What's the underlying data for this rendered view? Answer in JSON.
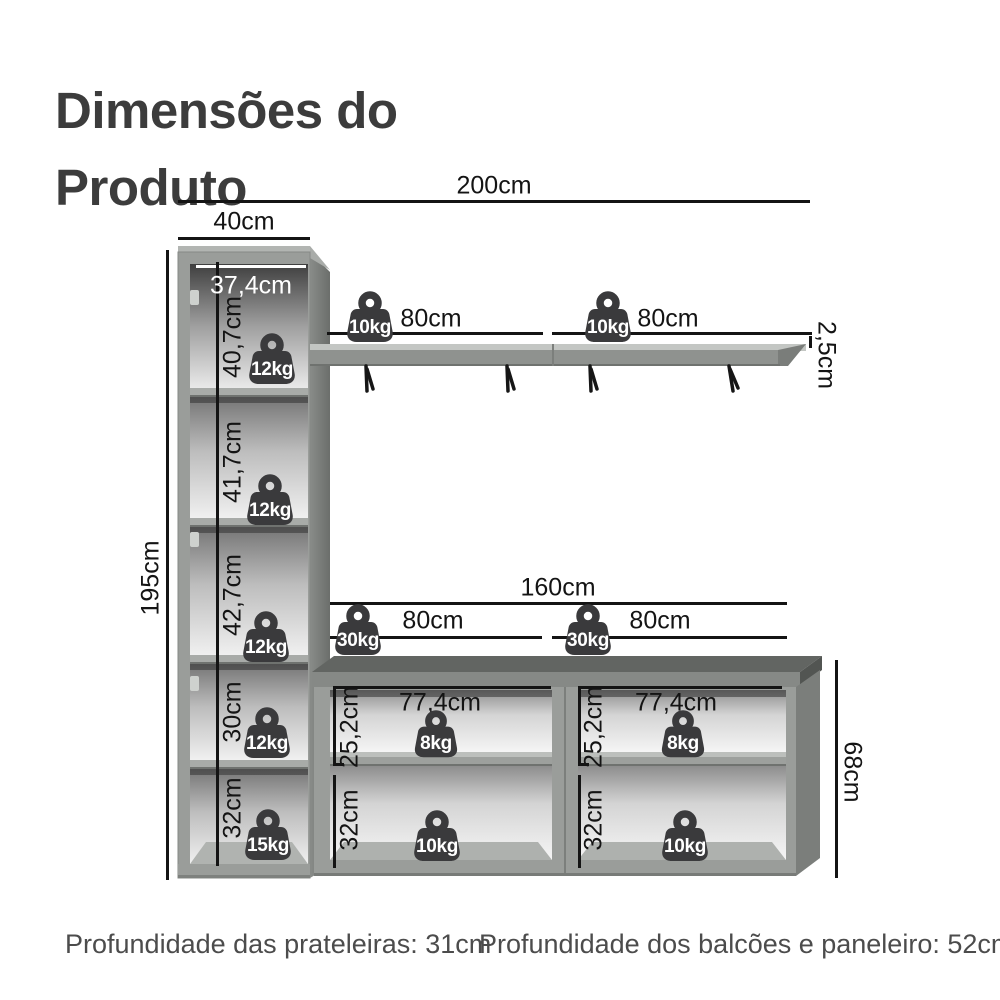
{
  "title": "Dimensões do Produto",
  "annotations": {
    "total_width": "200cm",
    "tower_width": "40cm",
    "tower_inner_width": "37,4cm",
    "tower_height": "195cm",
    "tower_sections": [
      "40,7cm",
      "41,7cm",
      "42,7cm",
      "30cm",
      "32cm"
    ],
    "shelf_left_span": "80cm",
    "shelf_right_span": "80cm",
    "shelf_thickness": "2,5cm",
    "counter_total_width": "160cm",
    "counter_left_span": "80cm",
    "counter_right_span": "80cm",
    "counter_height": "68cm",
    "module_left_inner_width": "77,4cm",
    "module_right_inner_width": "77,4cm",
    "module_left_upper_height": "25,2cm",
    "module_right_upper_height": "25,2cm",
    "module_left_lower_height": "32cm",
    "module_right_lower_height": "32cm"
  },
  "weights": {
    "tower_s1": "12kg",
    "tower_s2": "12kg",
    "tower_s3": "12kg",
    "tower_s4": "12kg",
    "tower_s5": "15kg",
    "shelf_left": "10kg",
    "shelf_right": "10kg",
    "counter_left": "30kg",
    "counter_right": "30kg",
    "module_left_upper": "8kg",
    "module_right_upper": "8kg",
    "module_left_lower": "10kg",
    "module_right_lower": "10kg"
  },
  "footer": {
    "shelves_depth": "Profundidade das prateleiras: 31cm",
    "counters_depth": "Profundidade dos balcões e paneleiro: 52cm"
  },
  "colors": {
    "line": "#141414",
    "title_text": "#3c3c3c",
    "footer_text": "#4c4c4c",
    "badge": "#3a3a3c",
    "cabinet_frame": "#9a9d9a"
  }
}
